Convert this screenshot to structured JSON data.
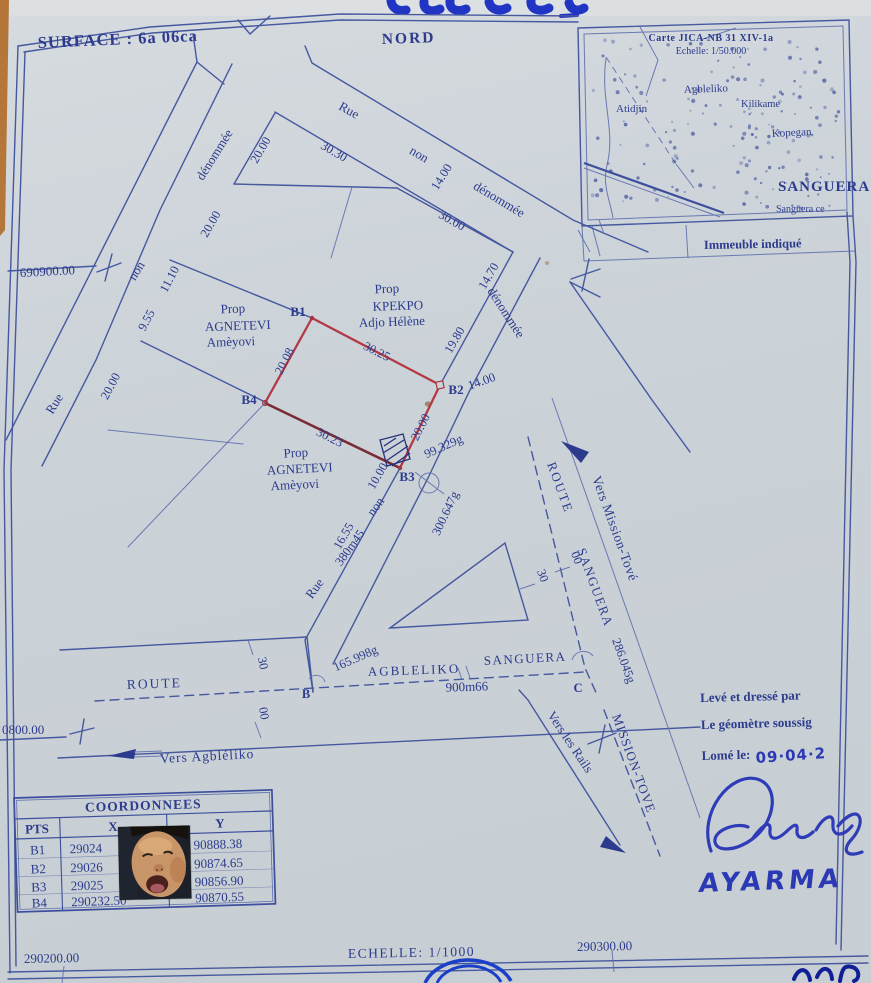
{
  "header": {
    "surface": "SURFACE : 6a 06ca",
    "north": "NORD"
  },
  "inset": {
    "title1": "Carte JICA-NB 31 XIV-1a",
    "title2": "Echelle: 1/50.000",
    "atidjin": "Atidjin",
    "agbleliko": "Agbleliko",
    "kilikame": "Kilikame",
    "kopegan": "Kopegan",
    "sanguera": "SANGUERA",
    "sanguera_centre": "Sanguera ce",
    "caption": "Immeuble indiqué"
  },
  "grid": {
    "north_y": "690900.00",
    "south_y": "0800.00",
    "west_x": "290200.00",
    "east_x": "290300.00",
    "scale": "ECHELLE: 1/1000"
  },
  "street": {
    "rue": "Rue",
    "non": "non",
    "denommee": "dénommée",
    "w14": "14.00",
    "len380": "380m45"
  },
  "dims": {
    "d20": "20.00",
    "d1110": "11.10",
    "d955": "9.55",
    "d3030": "30.30",
    "d3000": "30.00",
    "d1470": "14.70",
    "d1980": "19.80",
    "d1000": "10.00",
    "d1655": "16.55"
  },
  "parcel": {
    "b1": "B1",
    "b2": "B2",
    "b3": "B3",
    "b4": "B4",
    "top": "30.25",
    "right": "20.00",
    "bottom": "30.23",
    "left": "20.08",
    "angle_in": "99.329g",
    "angle_out": "300.647g"
  },
  "owners": {
    "prop": "Prop",
    "agnetevi": "AGNETEVI",
    "ameyovi": "Amèyovi",
    "kpekpo": "KPEKPO",
    "adjo": "Adjo Hélène"
  },
  "routes": {
    "route": "ROUTE",
    "agbleliko": "AGBLELIKO",
    "sanguera": "SANGUERA",
    "len900": "900m66",
    "angle_b": "165.998g",
    "angle_c": "286.045g",
    "pt_b": "B",
    "pt_c": "C",
    "mission": "MISSION-TOVE",
    "vers_mission": "Vers Mission-Tové",
    "vers_agbleliko": "Vers Agbléliko",
    "vers_rails": "Vers les Rails",
    "t30": "30",
    "t00": "00"
  },
  "table": {
    "title": "COORDONNEES",
    "col_pts": "PTS",
    "col_x": "X",
    "col_y": "Y",
    "rows": [
      {
        "pt": "B1",
        "x": "29024",
        "y": "90888.38"
      },
      {
        "pt": "B2",
        "x": "29026",
        "y": "90874.65"
      },
      {
        "pt": "B3",
        "x": "29025",
        "y": "90856.90"
      },
      {
        "pt": "B4",
        "x": "290232.50",
        "y": "90870.55"
      }
    ]
  },
  "attest": {
    "line1": "Levé et dressé par",
    "line2": "Le géomètre soussig",
    "line3": "Lomé le:",
    "date": "09·04·2",
    "name": "AYARMA"
  }
}
